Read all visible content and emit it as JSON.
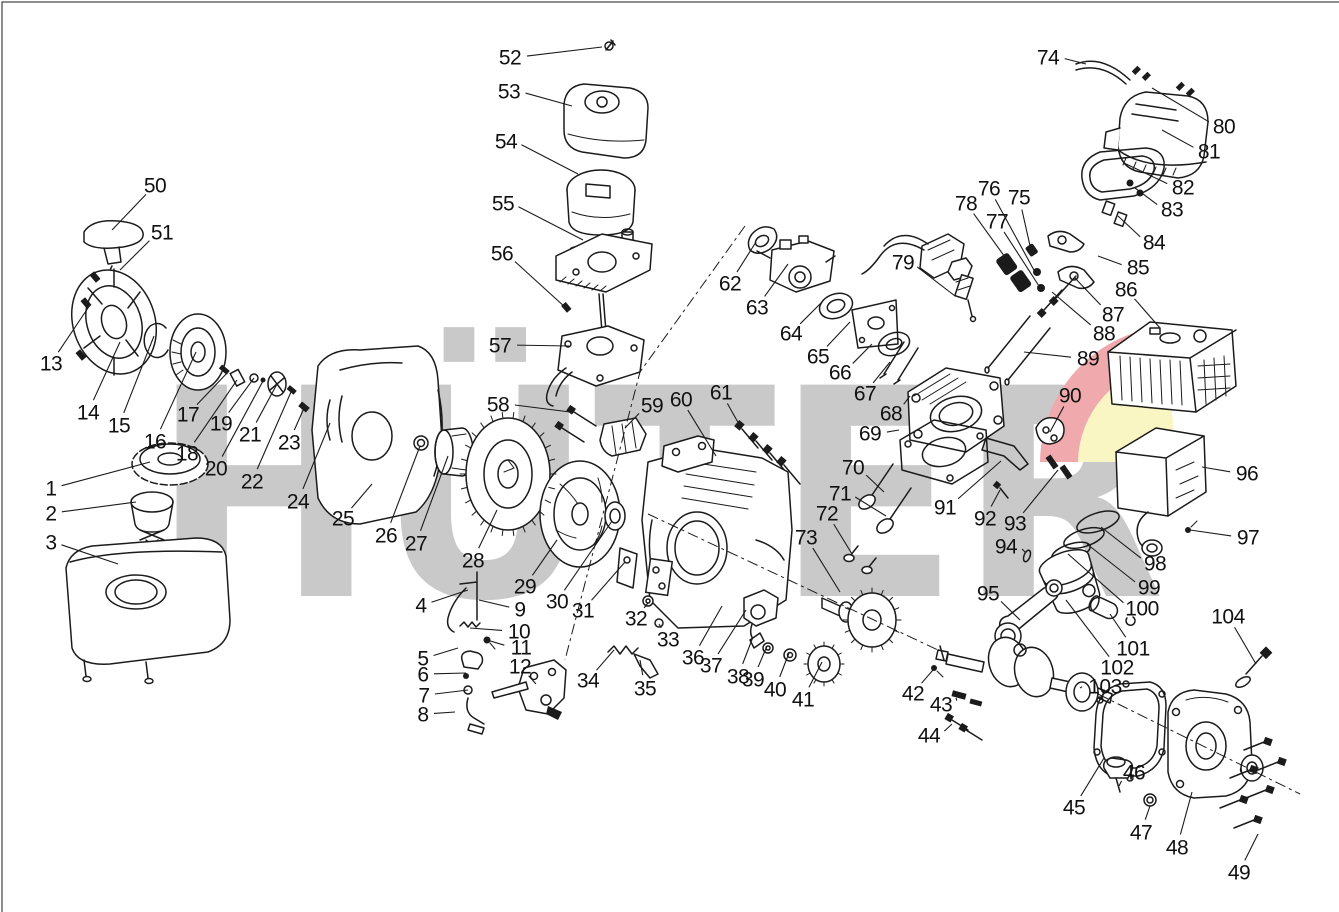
{
  "watermark": {
    "text": "HÜTER",
    "letter_color": "#c9c9c9",
    "swoosh_red": "#f0a9ac",
    "swoosh_yellow": "#faf6c3"
  },
  "speck_color": "#e8a33d",
  "labels_format": [
    "part_number",
    "label_x",
    "label_y",
    "leader_end_x",
    "leader_end_y"
  ],
  "labels": [
    [
      1,
      51,
      488,
      150,
      462
    ],
    [
      2,
      51,
      513,
      136,
      502
    ],
    [
      3,
      51,
      542,
      118,
      564
    ],
    [
      4,
      421,
      605,
      468,
      590
    ],
    [
      5,
      423,
      658,
      458,
      648
    ],
    [
      6,
      423,
      674,
      466,
      673
    ],
    [
      7,
      424,
      695,
      468,
      690
    ],
    [
      8,
      423,
      714,
      455,
      712
    ],
    [
      9,
      520,
      609,
      479,
      600
    ],
    [
      10,
      519,
      631,
      470,
      628
    ],
    [
      11,
      521,
      647,
      487,
      640
    ],
    [
      12,
      520,
      666,
      536,
      684
    ],
    [
      13,
      51,
      363,
      90,
      305
    ],
    [
      14,
      88,
      412,
      120,
      342
    ],
    [
      15,
      119,
      425,
      154,
      336
    ],
    [
      16,
      155,
      441,
      196,
      352
    ],
    [
      17,
      188,
      414,
      228,
      372
    ],
    [
      18,
      187,
      453,
      237,
      380
    ],
    [
      19,
      221,
      423,
      254,
      378
    ],
    [
      20,
      216,
      468,
      263,
      381
    ],
    [
      21,
      250,
      434,
      277,
      384
    ],
    [
      22,
      252,
      481,
      291,
      392
    ],
    [
      23,
      289,
      442,
      305,
      406
    ],
    [
      24,
      298,
      501,
      330,
      423
    ],
    [
      25,
      343,
      518,
      372,
      484
    ],
    [
      26,
      386,
      535,
      420,
      446
    ],
    [
      27,
      416,
      543,
      448,
      456
    ],
    [
      28,
      473,
      560,
      497,
      510
    ],
    [
      29,
      525,
      586,
      557,
      540
    ],
    [
      30,
      557,
      601,
      612,
      521
    ],
    [
      31,
      583,
      610,
      625,
      562
    ],
    [
      32,
      636,
      618,
      648,
      603
    ],
    [
      33,
      668,
      639,
      659,
      624
    ],
    [
      34,
      588,
      680,
      614,
      650
    ],
    [
      35,
      645,
      688,
      640,
      660
    ],
    [
      36,
      693,
      657,
      722,
      606
    ],
    [
      37,
      711,
      665,
      746,
      610
    ],
    [
      38,
      738,
      676,
      753,
      637
    ],
    [
      39,
      753,
      679,
      767,
      646
    ],
    [
      40,
      775,
      689,
      789,
      653
    ],
    [
      41,
      803,
      699,
      822,
      662
    ],
    [
      42,
      913,
      693,
      933,
      670
    ],
    [
      43,
      941,
      704,
      956,
      698
    ],
    [
      44,
      929,
      735,
      952,
      724
    ],
    [
      45,
      1074,
      807,
      1104,
      758
    ],
    [
      46,
      1134,
      772,
      1119,
      786
    ],
    [
      47,
      1141,
      832,
      1150,
      806
    ],
    [
      48,
      1177,
      847,
      1192,
      792
    ],
    [
      49,
      1239,
      872,
      1258,
      834
    ],
    [
      50,
      155,
      185,
      112,
      230
    ],
    [
      51,
      162,
      232,
      120,
      270
    ],
    [
      52,
      510,
      57,
      602,
      47
    ],
    [
      53,
      509,
      91,
      572,
      106
    ],
    [
      54,
      506,
      141,
      578,
      174
    ],
    [
      55,
      503,
      203,
      583,
      240
    ],
    [
      56,
      502,
      253,
      566,
      308
    ],
    [
      57,
      500,
      345,
      569,
      346
    ],
    [
      58,
      498,
      404,
      570,
      412
    ],
    [
      59,
      652,
      405,
      625,
      428
    ],
    [
      60,
      681,
      399,
      716,
      456
    ],
    [
      61,
      721,
      392,
      740,
      426
    ],
    [
      62,
      730,
      283,
      756,
      242
    ],
    [
      63,
      757,
      307,
      788,
      264
    ],
    [
      64,
      791,
      333,
      822,
      302
    ],
    [
      65,
      818,
      356,
      850,
      322
    ],
    [
      66,
      840,
      372,
      872,
      344
    ],
    [
      67,
      865,
      393,
      890,
      362
    ],
    [
      68,
      891,
      413,
      910,
      396
    ],
    [
      69,
      870,
      433,
      899,
      430
    ],
    [
      70,
      853,
      467,
      884,
      492
    ],
    [
      71,
      840,
      493,
      886,
      516
    ],
    [
      72,
      827,
      513,
      852,
      554
    ],
    [
      73,
      806,
      537,
      840,
      592
    ],
    [
      74,
      1048,
      57,
      1086,
      64
    ],
    [
      75,
      1019,
      197,
      1031,
      250
    ],
    [
      76,
      989,
      188,
      1035,
      272
    ],
    [
      77,
      997,
      221,
      1039,
      286
    ],
    [
      78,
      966,
      203,
      1010,
      264
    ],
    [
      79,
      903,
      262,
      955,
      296
    ],
    [
      80,
      1224,
      126,
      1152,
      88
    ],
    [
      81,
      1209,
      151,
      1162,
      130
    ],
    [
      82,
      1183,
      187,
      1124,
      163
    ],
    [
      83,
      1172,
      209,
      1135,
      188
    ],
    [
      84,
      1154,
      242,
      1118,
      216
    ],
    [
      85,
      1138,
      267,
      1098,
      256
    ],
    [
      86,
      1126,
      289,
      1160,
      328
    ],
    [
      87,
      1113,
      314,
      1074,
      277
    ],
    [
      88,
      1104,
      333,
      1052,
      292
    ],
    [
      89,
      1088,
      358,
      1024,
      352
    ],
    [
      90,
      1070,
      395,
      1050,
      432
    ],
    [
      91,
      945,
      507,
      1001,
      461
    ],
    [
      92,
      985,
      518,
      1000,
      490
    ],
    [
      93,
      1015,
      523,
      1058,
      470
    ],
    [
      94,
      1006,
      546,
      1026,
      553
    ],
    [
      95,
      988,
      593,
      1020,
      620
    ],
    [
      96,
      1247,
      473,
      1202,
      467
    ],
    [
      97,
      1248,
      537,
      1190,
      530
    ],
    [
      98,
      1155,
      563,
      1101,
      527
    ],
    [
      99,
      1149,
      587,
      1087,
      544
    ],
    [
      100,
      1142,
      608,
      1068,
      554
    ],
    [
      101,
      1133,
      648,
      1110,
      614
    ],
    [
      102,
      1117,
      667,
      1066,
      600
    ],
    [
      103,
      1105,
      686,
      1080,
      688
    ],
    [
      104,
      1228,
      616,
      1256,
      664
    ]
  ]
}
